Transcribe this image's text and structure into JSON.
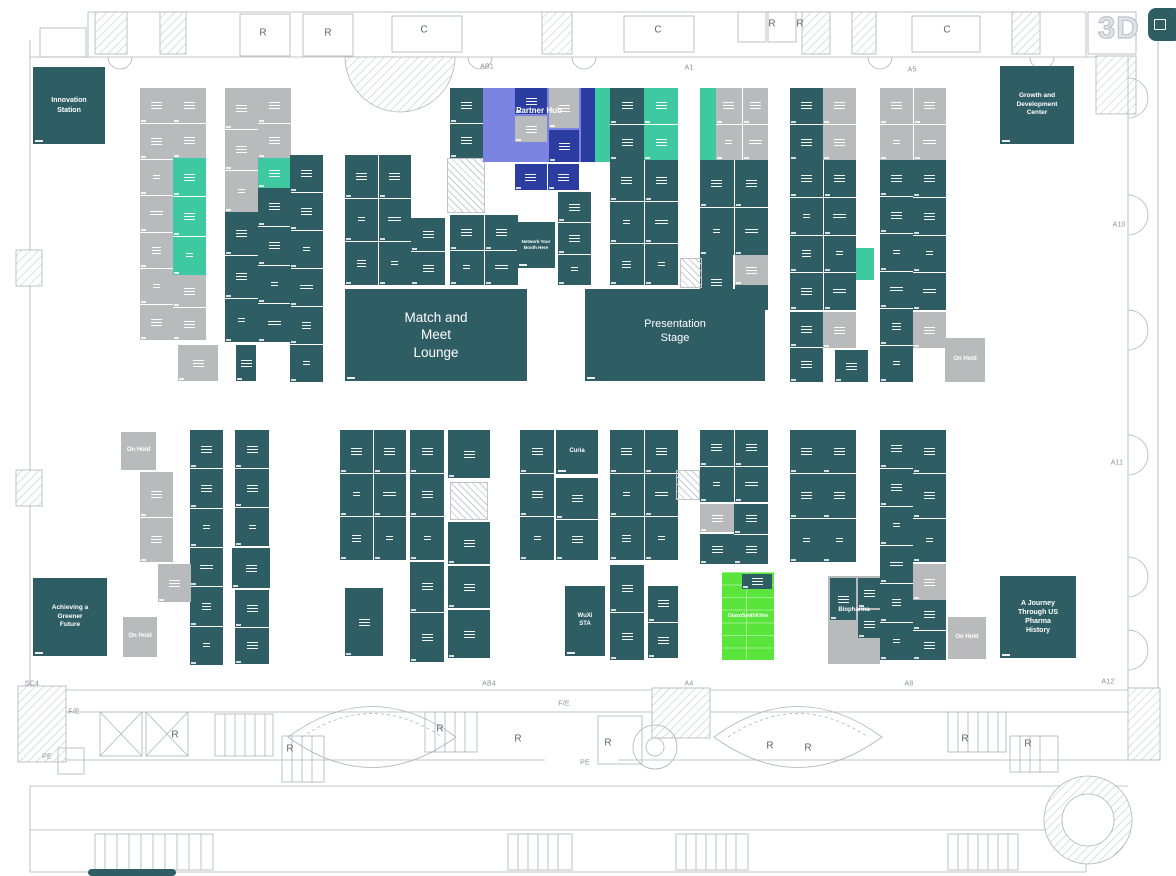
{
  "canvas": {
    "width": 1176,
    "height": 876
  },
  "palette": {
    "teal": "#2e5d63",
    "mint": "#3fc9a1",
    "gray": "#b9babc",
    "periwinkle": "#7b84e0",
    "navy": "#2b3da0",
    "green": "#59e53c",
    "line": "#aeb4bc",
    "hatch_line": "#c6ccd3",
    "letter_color": "#5f656d",
    "small_label_color": "#8b9199",
    "mode3d_color": "#dfe3e8"
  },
  "toolbar": {
    "mode_3d": "3D",
    "fab_icon": "fullscreen-icon"
  },
  "blocks": [
    {
      "x": 140,
      "y": 88,
      "w": 33,
      "h": 252,
      "c": "gray",
      "r": 7
    },
    {
      "x": 173,
      "y": 88,
      "w": 33,
      "h": 70,
      "c": "gray",
      "r": 2
    },
    {
      "x": 173,
      "y": 158,
      "w": 33,
      "h": 117,
      "c": "mint",
      "r": 3
    },
    {
      "x": 173,
      "y": 275,
      "w": 33,
      "h": 65,
      "c": "gray",
      "r": 2
    },
    {
      "x": 225,
      "y": 88,
      "w": 33,
      "h": 124,
      "c": "gray",
      "r": 3
    },
    {
      "x": 225,
      "y": 212,
      "w": 33,
      "h": 130,
      "c": "teal",
      "r": 3
    },
    {
      "x": 258,
      "y": 88,
      "w": 33,
      "h": 70,
      "c": "gray",
      "r": 2
    },
    {
      "x": 258,
      "y": 158,
      "w": 33,
      "h": 30,
      "c": "mint"
    },
    {
      "x": 258,
      "y": 188,
      "w": 33,
      "h": 154,
      "c": "teal",
      "r": 4
    },
    {
      "x": 290,
      "y": 155,
      "w": 33,
      "h": 227,
      "c": "teal",
      "r": 6
    },
    {
      "x": 178,
      "y": 345,
      "w": 40,
      "h": 36,
      "c": "gray"
    },
    {
      "x": 236,
      "y": 345,
      "w": 20,
      "h": 36,
      "c": "teal"
    },
    {
      "x": 345,
      "y": 155,
      "w": 66,
      "h": 130,
      "c": "teal",
      "r": 3,
      "k": 2
    },
    {
      "x": 411,
      "y": 218,
      "w": 34,
      "h": 67,
      "c": "teal",
      "r": 2
    },
    {
      "name": "hatched-column",
      "x": 447,
      "y": 158,
      "w": 38,
      "h": 55,
      "c": "hatch",
      "plain": true
    },
    {
      "x": 450,
      "y": 215,
      "w": 68,
      "h": 70,
      "c": "teal",
      "r": 2,
      "k": 2
    },
    {
      "x": 450,
      "y": 88,
      "w": 33,
      "h": 70,
      "c": "teal",
      "r": 2
    },
    {
      "name": "partner-hub-zone",
      "x": 483,
      "y": 88,
      "w": 112,
      "h": 74,
      "c": "periwinkle",
      "plain": true
    },
    {
      "x": 515,
      "y": 88,
      "w": 32,
      "h": 26,
      "c": "navy"
    },
    {
      "x": 549,
      "y": 88,
      "w": 30,
      "h": 40,
      "c": "gray"
    },
    {
      "x": 549,
      "y": 130,
      "w": 30,
      "h": 32,
      "c": "navy"
    },
    {
      "x": 515,
      "y": 116,
      "w": 32,
      "h": 26,
      "c": "gray"
    },
    {
      "x": 581,
      "y": 88,
      "w": 14,
      "h": 74,
      "c": "navy",
      "plain": true
    },
    {
      "x": 595,
      "y": 88,
      "w": 15,
      "h": 74,
      "c": "mint",
      "plain": true
    },
    {
      "name": "partner-hub-label",
      "x": 489,
      "y": 100,
      "w": 100,
      "h": 22,
      "c": "none",
      "label": "Partner Hub",
      "fs": 8,
      "bold": true
    },
    {
      "x": 515,
      "y": 164,
      "w": 64,
      "h": 26,
      "c": "navy",
      "k": 2
    },
    {
      "name": "network-your-booth-here",
      "x": 517,
      "y": 222,
      "w": 38,
      "h": 46,
      "c": "teal",
      "label": "Network Your Booth Here",
      "fs": 4.5,
      "bold": true,
      "num": true,
      "mw": 30
    },
    {
      "x": 558,
      "y": 192,
      "w": 33,
      "h": 93,
      "c": "teal",
      "r": 3
    },
    {
      "x": 610,
      "y": 88,
      "w": 34,
      "h": 72,
      "c": "teal",
      "r": 2
    },
    {
      "x": 644,
      "y": 88,
      "w": 34,
      "h": 72,
      "c": "mint",
      "r": 2
    },
    {
      "x": 700,
      "y": 88,
      "w": 16,
      "h": 72,
      "c": "mint",
      "plain": true
    },
    {
      "x": 716,
      "y": 88,
      "w": 52,
      "h": 72,
      "c": "gray",
      "r": 2,
      "k": 2
    },
    {
      "x": 610,
      "y": 160,
      "w": 68,
      "h": 125,
      "c": "teal",
      "r": 3,
      "k": 2
    },
    {
      "x": 700,
      "y": 160,
      "w": 68,
      "h": 95,
      "c": "teal",
      "r": 2,
      "k": 2
    },
    {
      "x": 735,
      "y": 255,
      "w": 33,
      "h": 30,
      "c": "gray"
    },
    {
      "x": 700,
      "y": 255,
      "w": 33,
      "h": 55,
      "c": "teal"
    },
    {
      "x": 735,
      "y": 285,
      "w": 33,
      "h": 25,
      "c": "teal"
    },
    {
      "name": "hatched-column",
      "x": 680,
      "y": 258,
      "w": 22,
      "h": 30,
      "c": "hatch",
      "plain": true
    },
    {
      "x": 790,
      "y": 88,
      "w": 33,
      "h": 72,
      "c": "teal",
      "r": 2
    },
    {
      "x": 823,
      "y": 88,
      "w": 33,
      "h": 72,
      "c": "gray",
      "r": 2
    },
    {
      "x": 790,
      "y": 160,
      "w": 66,
      "h": 150,
      "c": "teal",
      "r": 4,
      "k": 2
    },
    {
      "x": 790,
      "y": 312,
      "w": 33,
      "h": 70,
      "c": "teal",
      "r": 2
    },
    {
      "x": 823,
      "y": 312,
      "w": 33,
      "h": 36,
      "c": "gray"
    },
    {
      "x": 835,
      "y": 350,
      "w": 33,
      "h": 32,
      "c": "teal"
    },
    {
      "x": 856,
      "y": 248,
      "w": 18,
      "h": 32,
      "c": "mint",
      "plain": true
    },
    {
      "x": 880,
      "y": 88,
      "w": 66,
      "h": 72,
      "c": "gray",
      "r": 2,
      "k": 2
    },
    {
      "x": 880,
      "y": 160,
      "w": 33,
      "h": 222,
      "c": "teal",
      "r": 6
    },
    {
      "x": 913,
      "y": 160,
      "w": 33,
      "h": 150,
      "c": "teal",
      "r": 4
    },
    {
      "x": 913,
      "y": 312,
      "w": 33,
      "h": 36,
      "c": "gray"
    },
    {
      "name": "on-hold-booth",
      "x": 945,
      "y": 338,
      "w": 40,
      "h": 44,
      "c": "gray",
      "label": "On Hold",
      "fs": 6,
      "bold": true,
      "mw": 24
    },
    {
      "name": "on-hold-booth",
      "x": 121,
      "y": 432,
      "w": 35,
      "h": 38,
      "c": "gray",
      "label": "On Hold",
      "fs": 6,
      "bold": true,
      "mw": 24
    },
    {
      "x": 140,
      "y": 472,
      "w": 33,
      "h": 90,
      "c": "gray",
      "r": 2
    },
    {
      "x": 190,
      "y": 430,
      "w": 33,
      "h": 235,
      "c": "teal",
      "r": 6
    },
    {
      "x": 158,
      "y": 564,
      "w": 33,
      "h": 38,
      "c": "gray"
    },
    {
      "name": "on-hold-booth",
      "x": 123,
      "y": 617,
      "w": 34,
      "h": 40,
      "c": "gray",
      "label": "On Hold",
      "fs": 6,
      "bold": true,
      "mw": 24
    },
    {
      "x": 235,
      "y": 430,
      "w": 34,
      "h": 116,
      "c": "teal",
      "r": 3
    },
    {
      "x": 232,
      "y": 548,
      "w": 38,
      "h": 40,
      "c": "teal"
    },
    {
      "x": 235,
      "y": 590,
      "w": 34,
      "h": 74,
      "c": "teal",
      "r": 2
    },
    {
      "x": 340,
      "y": 430,
      "w": 66,
      "h": 130,
      "c": "teal",
      "r": 3,
      "k": 2
    },
    {
      "x": 345,
      "y": 588,
      "w": 38,
      "h": 68,
      "c": "teal"
    },
    {
      "x": 410,
      "y": 430,
      "w": 34,
      "h": 130,
      "c": "teal",
      "r": 3
    },
    {
      "x": 410,
      "y": 562,
      "w": 34,
      "h": 100,
      "c": "teal",
      "r": 2
    },
    {
      "x": 448,
      "y": 430,
      "w": 42,
      "h": 48,
      "c": "teal"
    },
    {
      "name": "hatched-column",
      "x": 450,
      "y": 482,
      "w": 38,
      "h": 38,
      "c": "hatch",
      "plain": true
    },
    {
      "x": 448,
      "y": 522,
      "w": 42,
      "h": 42,
      "c": "teal"
    },
    {
      "x": 448,
      "y": 566,
      "w": 42,
      "h": 42,
      "c": "teal"
    },
    {
      "x": 448,
      "y": 610,
      "w": 42,
      "h": 48,
      "c": "teal"
    },
    {
      "x": 520,
      "y": 430,
      "w": 34,
      "h": 130,
      "c": "teal",
      "r": 3
    },
    {
      "name": "curia-booth",
      "x": 556,
      "y": 430,
      "w": 42,
      "h": 44,
      "c": "teal",
      "label": "Curia",
      "fs": 6,
      "bold": true,
      "num": true
    },
    {
      "x": 556,
      "y": 478,
      "w": 42,
      "h": 82,
      "c": "teal",
      "r": 2
    },
    {
      "name": "wuxi-sta-booth",
      "x": 565,
      "y": 586,
      "w": 40,
      "h": 70,
      "c": "teal",
      "label": "WuXi STA",
      "fs": 6,
      "bold": true,
      "num": true,
      "mw": 26
    },
    {
      "x": 610,
      "y": 430,
      "w": 68,
      "h": 130,
      "c": "teal",
      "r": 3,
      "k": 2
    },
    {
      "x": 610,
      "y": 565,
      "w": 34,
      "h": 95,
      "c": "teal",
      "r": 2
    },
    {
      "x": 648,
      "y": 586,
      "w": 30,
      "h": 72,
      "c": "teal",
      "r": 2
    },
    {
      "name": "hatched-column",
      "x": 676,
      "y": 470,
      "w": 24,
      "h": 30,
      "c": "hatch",
      "plain": true
    },
    {
      "x": 700,
      "y": 430,
      "w": 68,
      "h": 72,
      "c": "teal",
      "r": 2,
      "k": 2
    },
    {
      "x": 700,
      "y": 504,
      "w": 34,
      "h": 28,
      "c": "gray"
    },
    {
      "x": 734,
      "y": 504,
      "w": 34,
      "h": 60,
      "c": "teal",
      "r": 2
    },
    {
      "x": 700,
      "y": 534,
      "w": 34,
      "h": 30,
      "c": "teal"
    },
    {
      "name": "highlighted-booth-glaxosmithkline",
      "x": 722,
      "y": 572,
      "w": 52,
      "h": 88,
      "c": "green",
      "label": "GlaxoSmithKline",
      "fs": 5,
      "bold": true,
      "lines": 7
    },
    {
      "name": "booth-logo-chip",
      "x": 742,
      "y": 574,
      "w": 30,
      "h": 15,
      "c": "teal"
    },
    {
      "x": 790,
      "y": 430,
      "w": 33,
      "h": 132,
      "c": "teal",
      "r": 3
    },
    {
      "x": 823,
      "y": 430,
      "w": 33,
      "h": 132,
      "c": "teal",
      "r": 3
    },
    {
      "name": "biopharma-zone",
      "x": 828,
      "y": 576,
      "w": 52,
      "h": 88,
      "c": "gray",
      "plain": true
    },
    {
      "x": 830,
      "y": 578,
      "w": 26,
      "h": 42,
      "c": "teal"
    },
    {
      "x": 858,
      "y": 578,
      "w": 22,
      "h": 30,
      "c": "teal"
    },
    {
      "x": 858,
      "y": 610,
      "w": 22,
      "h": 28,
      "c": "teal"
    },
    {
      "name": "biopharma-label",
      "x": 826,
      "y": 604,
      "w": 56,
      "h": 14,
      "c": "none",
      "label": "Biopharma",
      "fs": 6,
      "bold": true
    },
    {
      "x": 880,
      "y": 430,
      "w": 33,
      "h": 230,
      "c": "teal",
      "r": 6
    },
    {
      "x": 913,
      "y": 430,
      "w": 33,
      "h": 132,
      "c": "teal",
      "r": 3
    },
    {
      "x": 913,
      "y": 564,
      "w": 33,
      "h": 36,
      "c": "gray"
    },
    {
      "x": 913,
      "y": 600,
      "w": 33,
      "h": 60,
      "c": "teal",
      "r": 2
    },
    {
      "name": "on-hold-booth",
      "x": 948,
      "y": 617,
      "w": 38,
      "h": 42,
      "c": "gray",
      "label": "On Hold",
      "fs": 6,
      "bold": true,
      "mw": 24
    },
    {
      "name": "innovation-station-area",
      "x": 33,
      "y": 67,
      "w": 72,
      "h": 77,
      "c": "teal",
      "label": "Innovation Station",
      "fs": 7,
      "bold": true,
      "num": true,
      "mw": 48
    },
    {
      "name": "growth-development-center-area",
      "x": 1000,
      "y": 66,
      "w": 74,
      "h": 78,
      "c": "teal",
      "label": "Growth and Development Center",
      "fs": 6.5,
      "bold": true,
      "num": true,
      "mw": 55
    },
    {
      "name": "match-and-meet-lounge",
      "x": 345,
      "y": 289,
      "w": 182,
      "h": 92,
      "c": "teal",
      "label": "Match and Meet Lounge",
      "fs": 13.5,
      "num": true,
      "mw": 64
    },
    {
      "name": "presentation-stage",
      "x": 585,
      "y": 289,
      "w": 180,
      "h": 92,
      "c": "teal",
      "label": "Presentation Stage",
      "fs": 11,
      "num": true,
      "mw": 92,
      "pad": 28
    },
    {
      "name": "achieving-greener-future-area",
      "x": 33,
      "y": 578,
      "w": 74,
      "h": 78,
      "c": "teal",
      "label": "Achieving a Greener Future",
      "fs": 6.5,
      "bold": true,
      "num": true,
      "mw": 45
    },
    {
      "name": "pharma-history-area",
      "x": 1000,
      "y": 576,
      "w": 76,
      "h": 82,
      "c": "teal",
      "label": "A Journey Through US Pharma History",
      "fs": 7,
      "bold": true,
      "num": true,
      "mw": 50
    },
    {
      "name": "map-artifact",
      "x": 88,
      "y": 869,
      "w": 88,
      "h": 7,
      "c": "teal",
      "plain": true,
      "round": true
    }
  ],
  "rooms": [
    {
      "t": "R",
      "x": 263,
      "y": 33
    },
    {
      "t": "R",
      "x": 328,
      "y": 33
    },
    {
      "t": "C",
      "x": 424,
      "y": 30
    },
    {
      "t": "C",
      "x": 658,
      "y": 30
    },
    {
      "t": "R",
      "x": 772,
      "y": 24
    },
    {
      "t": "R",
      "x": 800,
      "y": 24
    },
    {
      "t": "C",
      "x": 947,
      "y": 30
    },
    {
      "t": "R",
      "x": 175,
      "y": 735
    },
    {
      "t": "R",
      "x": 290,
      "y": 749
    },
    {
      "t": "R",
      "x": 440,
      "y": 729
    },
    {
      "t": "R",
      "x": 518,
      "y": 739
    },
    {
      "t": "R",
      "x": 608,
      "y": 743
    },
    {
      "t": "R",
      "x": 770,
      "y": 746
    },
    {
      "t": "R",
      "x": 808,
      "y": 748
    },
    {
      "t": "R",
      "x": 965,
      "y": 739
    },
    {
      "t": "R",
      "x": 1028,
      "y": 744
    }
  ],
  "perimeter_labels": [
    {
      "t": "AB1",
      "x": 487,
      "y": 67
    },
    {
      "t": "A1",
      "x": 689,
      "y": 68
    },
    {
      "t": "A5",
      "x": 912,
      "y": 70
    },
    {
      "t": "A10",
      "x": 1119,
      "y": 225
    },
    {
      "t": "A11",
      "x": 1117,
      "y": 463
    },
    {
      "t": "SC4",
      "x": 32,
      "y": 684
    },
    {
      "t": "F/E",
      "x": 74,
      "y": 712
    },
    {
      "t": "AB4",
      "x": 489,
      "y": 684
    },
    {
      "t": "F/E",
      "x": 564,
      "y": 704
    },
    {
      "t": "A4",
      "x": 689,
      "y": 684
    },
    {
      "t": "PE",
      "x": 585,
      "y": 763
    },
    {
      "t": "PE",
      "x": 47,
      "y": 757
    },
    {
      "t": "A8",
      "x": 909,
      "y": 684
    },
    {
      "t": "A12",
      "x": 1108,
      "y": 682
    }
  ]
}
